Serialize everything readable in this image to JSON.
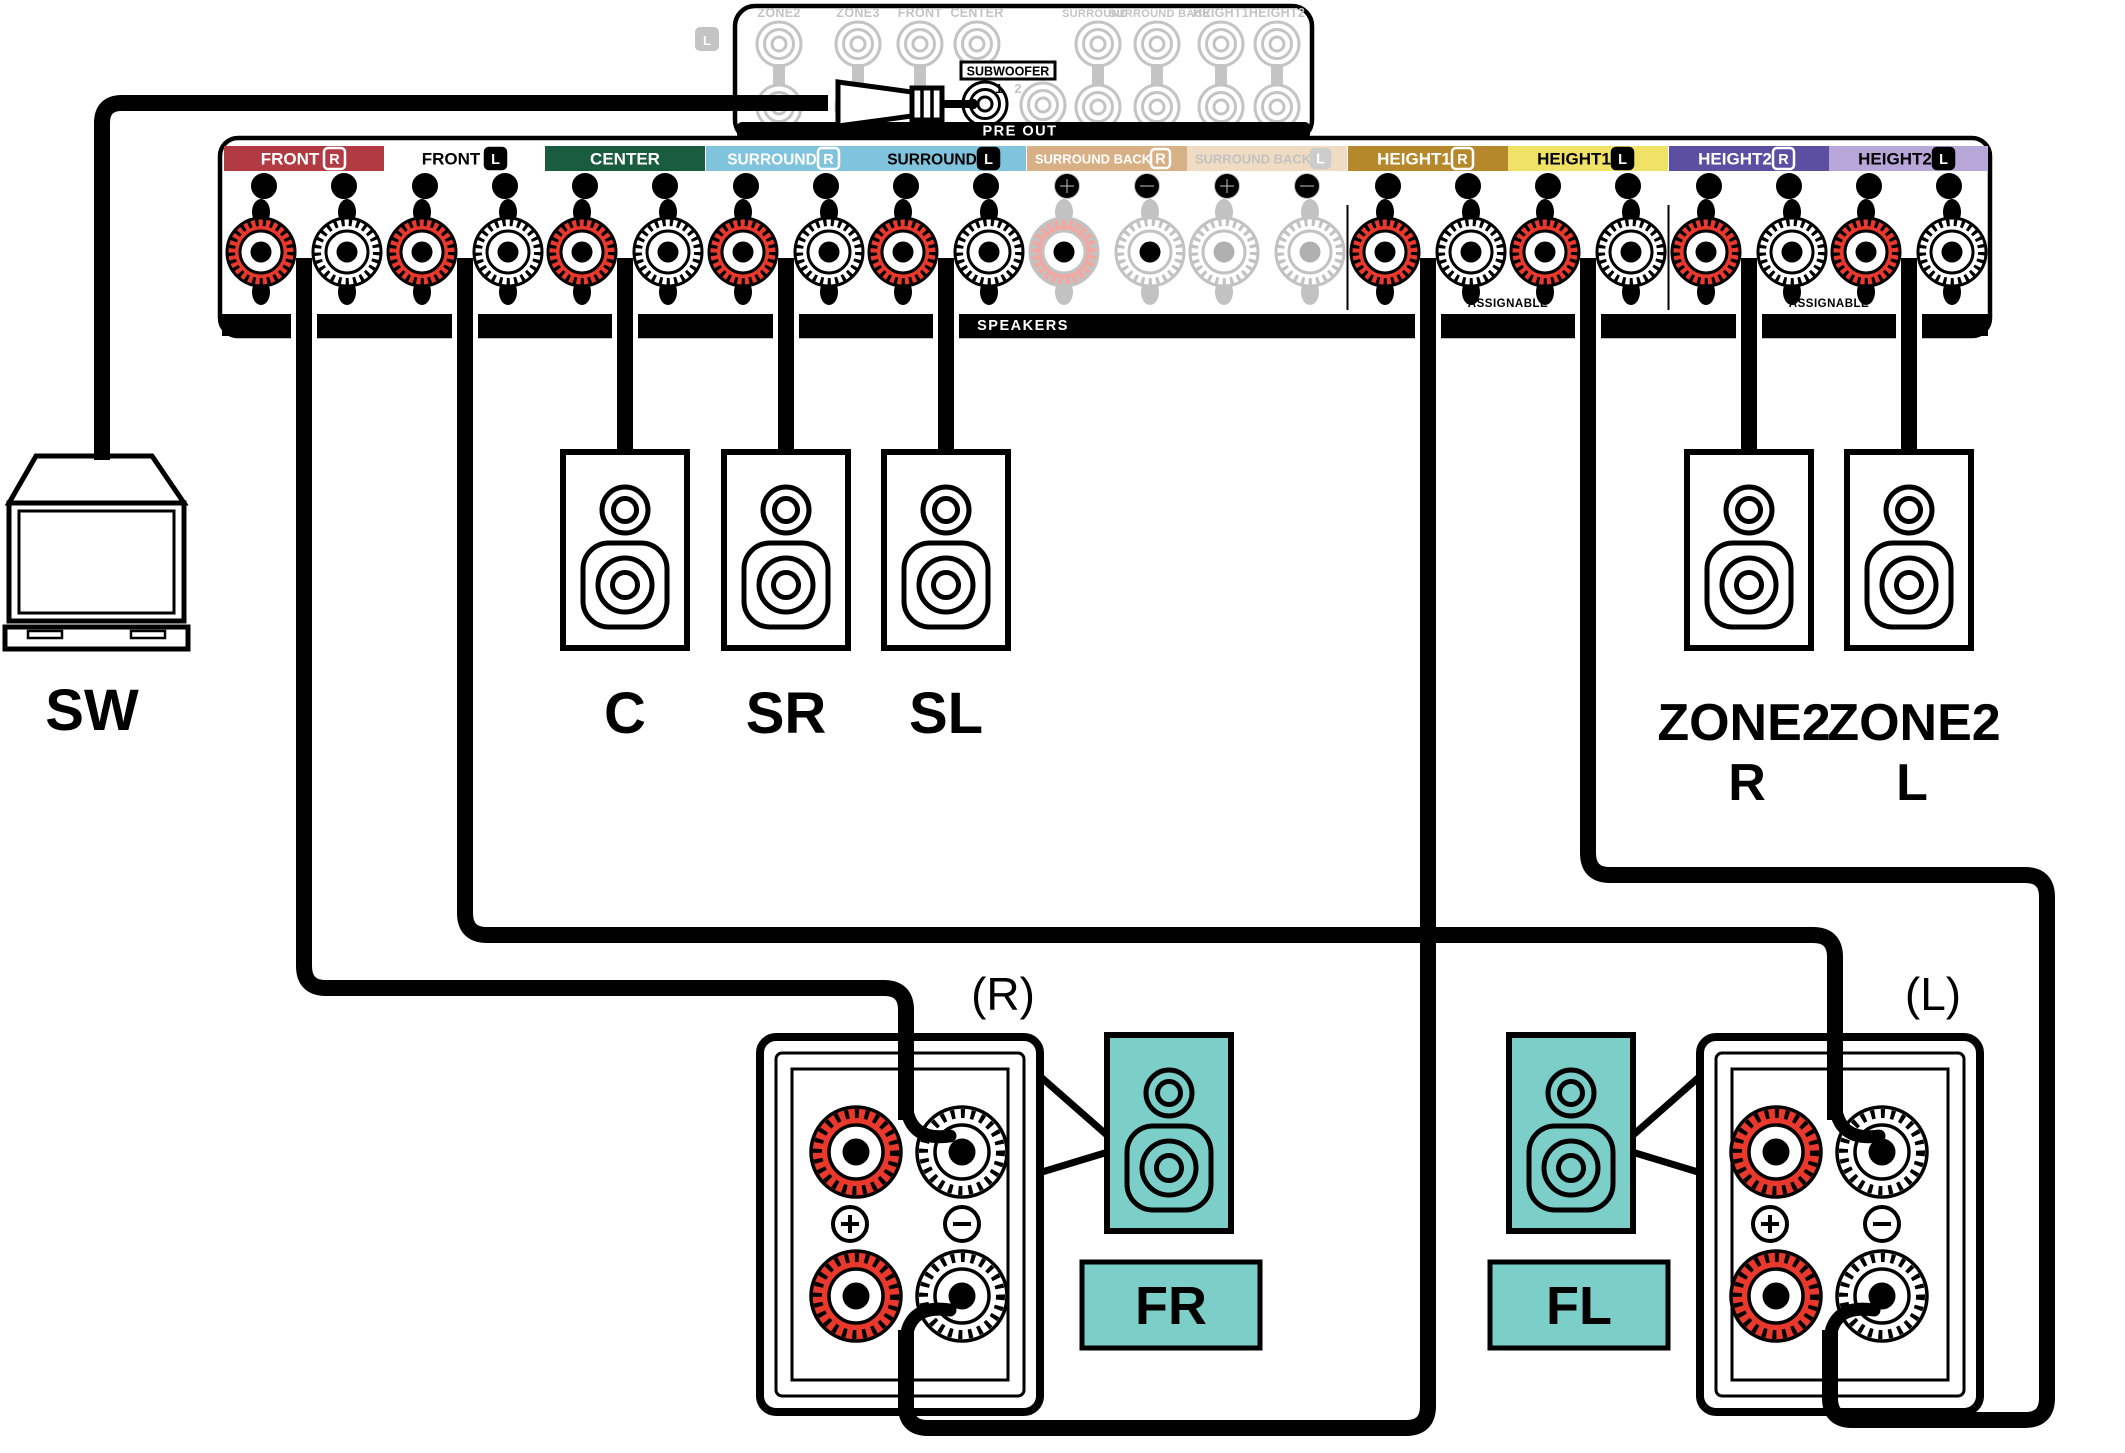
{
  "colors": {
    "post_red": "#e8392c",
    "faded_post_red": "#f0a8a0",
    "inactive_gray": "#c2c2c2",
    "front_red_bar": "#b23a42",
    "center_green_bar": "#1a5c40",
    "surround_blue_bar": "#7fc3dc",
    "surround_back_tan_bar": "#d8b085",
    "surround_back_faded_bar": "#f0dcc2",
    "height1_gold_bar": "#b5892b",
    "height1_yellow_bar": "#f0e167",
    "height2_purple_bar": "#5c4fa2",
    "height2_lavender_bar": "#b9a6d8",
    "speaker_teal": "#7ccfc9"
  },
  "preout": {
    "panel_label": "PRE OUT",
    "channel_badge": "L",
    "jacks": [
      "ZONE2",
      "ZONE3",
      "FRONT",
      "CENTER",
      "SURROUND",
      "SURROUND BACK",
      "HEIGHT1",
      "HEIGHT2"
    ],
    "subwoofer_label": "SUBWOOFER",
    "subwoofer_jack1": "1",
    "subwoofer_jack2": "2"
  },
  "strip": {
    "panel_label": "SPEAKERS",
    "assignable": "ASSIGNABLE",
    "sections": [
      {
        "label": "FRONT",
        "badge": "R",
        "bar": "#b23a42",
        "text": "#ffffff",
        "badge_fill": "none",
        "badge_stroke": "#ffffff",
        "sym": "#000000",
        "state": "active"
      },
      {
        "label": "FRONT",
        "badge": "L",
        "bar": "none",
        "text": "#000000",
        "badge_fill": "#000000",
        "badge_stroke": "#000000",
        "sym": "#000000",
        "state": "active"
      },
      {
        "label": "CENTER",
        "badge": "",
        "bar": "#1a5c40",
        "text": "#ffffff",
        "badge_fill": "none",
        "badge_stroke": "none",
        "sym": "#000000",
        "state": "active"
      },
      {
        "label": "SURROUND",
        "badge": "R",
        "bar": "#7fc3dc",
        "text": "#ffffff",
        "badge_fill": "none",
        "badge_stroke": "#ffffff",
        "sym": "#000000",
        "state": "active"
      },
      {
        "label": "SURROUND",
        "badge": "L",
        "bar": "#7fc3dc",
        "text": "#000000",
        "badge_fill": "#000000",
        "badge_stroke": "#000000",
        "sym": "#000000",
        "state": "active"
      },
      {
        "label": "SURROUND BACK",
        "badge": "R",
        "bar": "#d8b085",
        "text": "#ffffff",
        "badge_fill": "none",
        "badge_stroke": "#ffffff",
        "sym": "#c2c2c2",
        "state": "inactive"
      },
      {
        "label": "SURROUND BACK",
        "badge": "L",
        "bar": "#f0dcc2",
        "text": "#c2c2c2",
        "badge_fill": "#cccccc",
        "badge_stroke": "#cccccc",
        "sym": "#c9c9c9",
        "state": "inactive"
      },
      {
        "label": "HEIGHT1",
        "badge": "R",
        "bar": "#b5892b",
        "text": "#ffffff",
        "badge_fill": "none",
        "badge_stroke": "#ffffff",
        "sym": "#000000",
        "state": "active"
      },
      {
        "label": "HEIGHT1",
        "badge": "L",
        "bar": "#f0e167",
        "text": "#000000",
        "badge_fill": "#000000",
        "badge_stroke": "#000000",
        "sym": "#000000",
        "state": "active"
      },
      {
        "label": "HEIGHT2",
        "badge": "R",
        "bar": "#5c4fa2",
        "text": "#ffffff",
        "badge_fill": "none",
        "badge_stroke": "#ffffff",
        "sym": "#000000",
        "state": "active"
      },
      {
        "label": "HEIGHT2",
        "badge": "L",
        "bar": "#b9a6d8",
        "text": "#000000",
        "badge_fill": "#000000",
        "badge_stroke": "#000000",
        "sym": "#000000",
        "state": "active"
      }
    ]
  },
  "speakers": {
    "subwoofer": "SW",
    "center": "C",
    "surround_right": "SR",
    "surround_left": "SL",
    "zone2": "ZONE2",
    "zone2_right": "R",
    "zone2_left": "L"
  },
  "biamp": {
    "right": "(R)",
    "left": "(L)",
    "front_right": "FR",
    "front_left": "FL"
  }
}
